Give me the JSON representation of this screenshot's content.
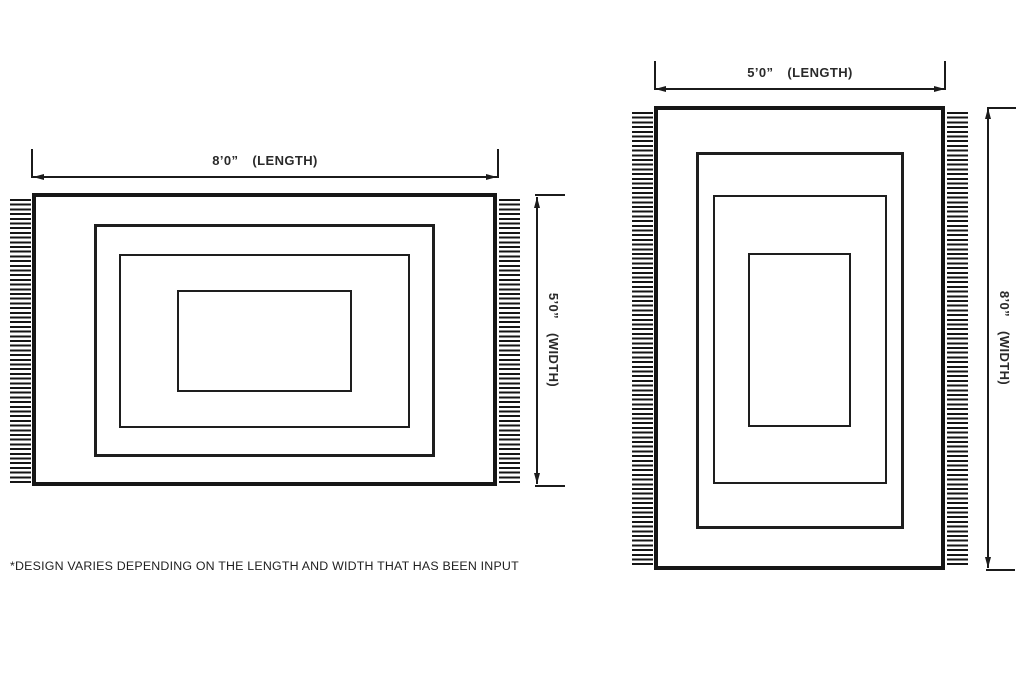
{
  "diagram": {
    "title": "rug size diagram",
    "footnote": "*DESIGN VARIES DEPENDING ON THE LENGTH AND WIDTH THAT HAS BEEN INPUT",
    "colors": {
      "line": "#1b1b1b",
      "text": "#2a2a2a",
      "background": "#ffffff"
    },
    "rugs": [
      {
        "name": "landscape rug 8ft by 5ft",
        "length": {
          "value": "8’0”",
          "unit": "(LENGTH)"
        },
        "width": {
          "value": "5’0”",
          "unit": "(WIDTH)"
        }
      },
      {
        "name": "portrait rug 5ft by 8ft",
        "length": {
          "value": "5’0”",
          "unit": "(LENGTH)"
        },
        "width": {
          "value": "8’0”",
          "unit": "(WIDTH)"
        }
      }
    ]
  }
}
